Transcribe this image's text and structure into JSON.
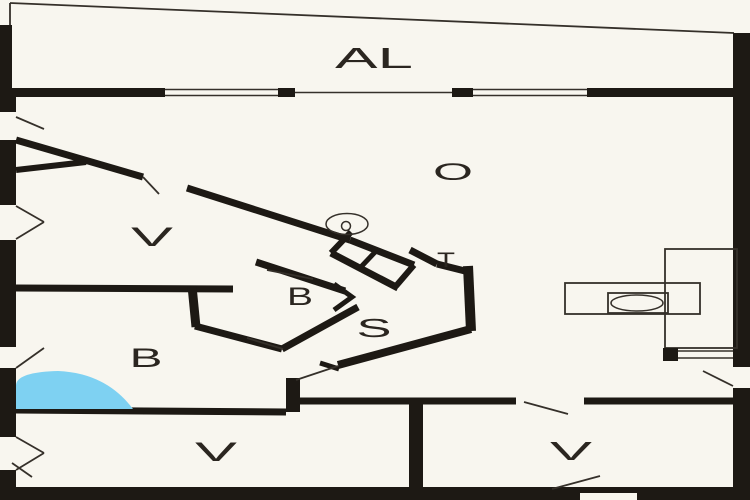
{
  "plan": {
    "type": "floor-plan",
    "description": "Holiday home floor plan with balcony strip, large living area, angled sauna/bath block, spa bath and kitchen fixtures"
  },
  "rooms": [
    {
      "id": "balcony",
      "label": "AL",
      "x": 374,
      "y": 68,
      "size": 29,
      "stretch": 78
    },
    {
      "id": "living-room",
      "label": "O",
      "x": 453,
      "y": 180,
      "size": 24,
      "stretch": 40
    },
    {
      "id": "room-top-left",
      "label": "V",
      "x": 152,
      "y": 246,
      "size": 27,
      "stretch": 42
    },
    {
      "id": "bath-left",
      "label": "B",
      "x": 146,
      "y": 367,
      "size": 27,
      "stretch": 33
    },
    {
      "id": "bath-center",
      "label": "B",
      "x": 300,
      "y": 305,
      "size": 25,
      "stretch": 26
    },
    {
      "id": "toilet",
      "label": "T",
      "x": 446,
      "y": 267,
      "size": 21,
      "stretch": 18
    },
    {
      "id": "sauna",
      "label": "S",
      "x": 374,
      "y": 337,
      "size": 26,
      "stretch": 35
    },
    {
      "id": "room-bottom-left",
      "label": "V",
      "x": 216,
      "y": 461,
      "size": 27,
      "stretch": 42
    },
    {
      "id": "room-bottom-right",
      "label": "V",
      "x": 571,
      "y": 460,
      "size": 26,
      "stretch": 42
    }
  ],
  "colors": {
    "background": "#f8f6ef",
    "wall": "#1d1914",
    "line": "#35302a",
    "water": "#7ed1f2",
    "text": "#2b2620"
  },
  "fixtures": [
    {
      "id": "spa-bath",
      "color": "#7ed1f2"
    },
    {
      "id": "stove",
      "color": "#f8f6ef"
    },
    {
      "id": "kitchen-counter",
      "color": "#f8f6ef"
    },
    {
      "id": "ceiling-lamp",
      "color": "#f8f6ef"
    }
  ]
}
